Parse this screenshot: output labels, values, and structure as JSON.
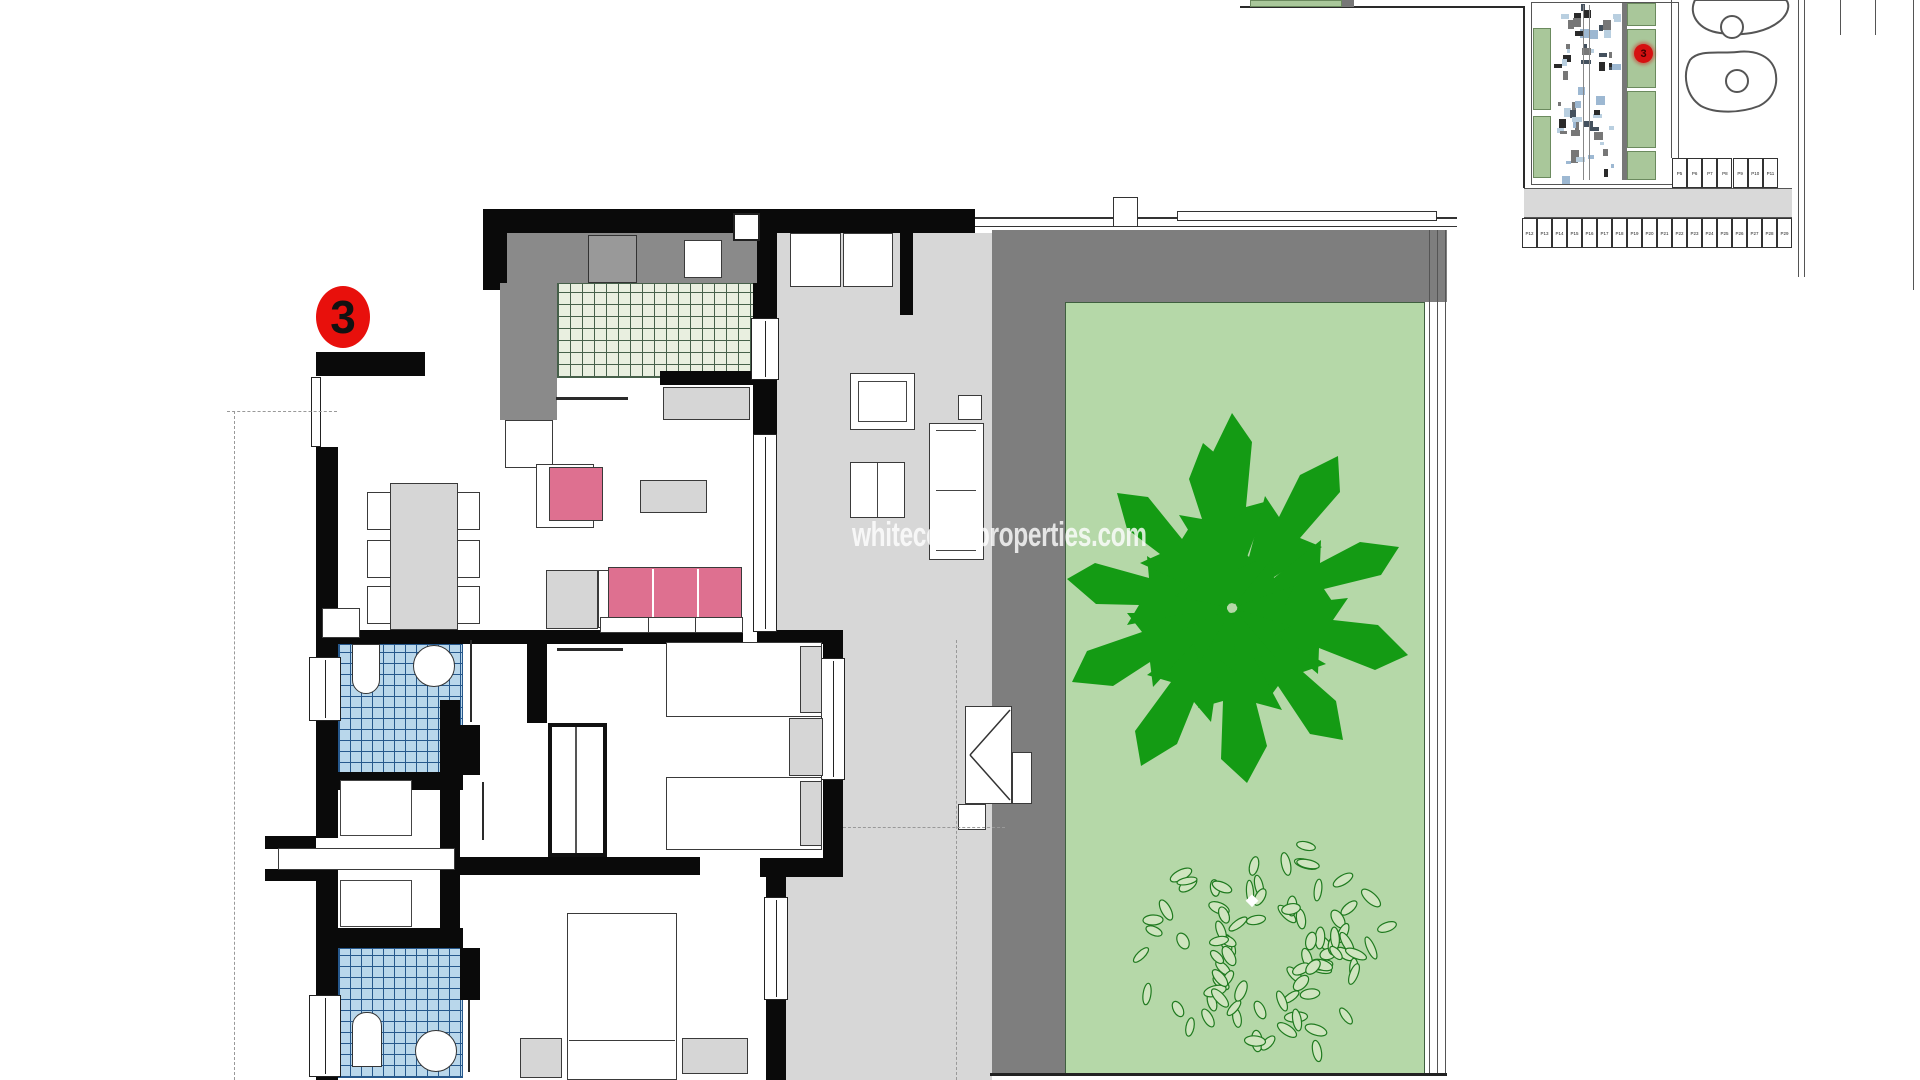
{
  "watermark": {
    "text": "whitecoastproperties.com"
  },
  "unit_badge": {
    "label": "3"
  },
  "minimap": {
    "unit_badge": "3",
    "parking_side_labels": [
      "P5",
      "P6",
      "P7",
      "P8",
      "P9",
      "P10",
      "P11"
    ],
    "parking_bottom_labels": [
      "P12",
      "P13",
      "P14",
      "P15",
      "P16",
      "P17",
      "P18",
      "P19",
      "P20",
      "P21",
      "P22",
      "P23",
      "P24",
      "P25",
      "P26",
      "P27",
      "P28",
      "P29"
    ]
  },
  "colors": {
    "wall": "#0a0a0a",
    "terrace_gray": "#d7d7d7",
    "planter_gray": "#7e7e7e",
    "counter_gray": "#8a8a8a",
    "garden_green": "#b5d8a8",
    "tree_green": "#149b14",
    "kitchen_tile": "#e9efe0",
    "bath_tile": "#b9d7eb",
    "sofa_pink": "#de7090",
    "badge_red": "#e8100c",
    "minimap_green": "#a9c79a"
  }
}
